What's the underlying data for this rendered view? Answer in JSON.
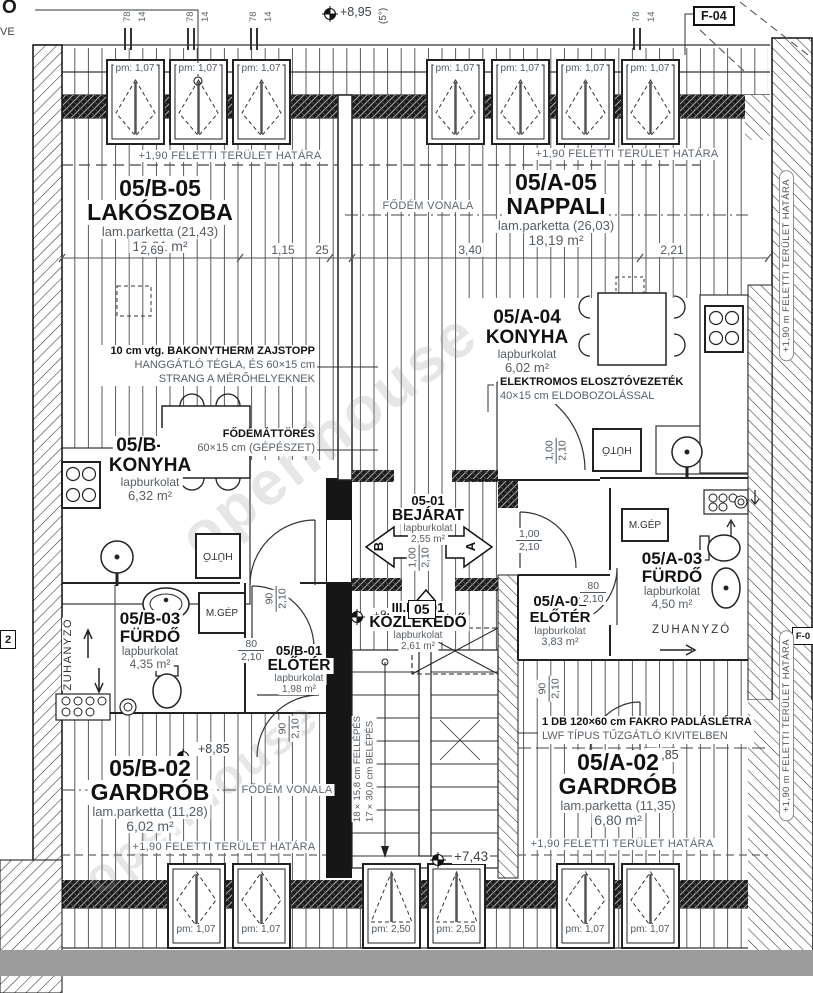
{
  "sheet": {
    "code": "F-04",
    "corner_top": "O",
    "corner_sub": "VE",
    "left_cut": "2",
    "right_cut": "F-0",
    "watermark": "openhouse"
  },
  "notes": {
    "boundary": "+1,90 FELETTI TERÜLET HATÁRA",
    "boundary_side": "+1,90 m FELETTI TERÜLET HATÁRA",
    "fodem": "FŐDÉM VONALA"
  },
  "levels": {
    "roof": "+8,95",
    "roof_angle": "(5°)",
    "entry": "+8,85",
    "gardrob_b": "+8,85",
    "gardrob_a": "+8,85",
    "stair": "+7,43"
  },
  "rooms": [
    {
      "id": "05/B-05",
      "name": "LAKÓSZOBA",
      "finish": "lam.parketta (21,43)",
      "area": "16,01 m²"
    },
    {
      "id": "05/A-05",
      "name": "NAPPALI",
      "finish": "lam.parketta (26,03)",
      "area": "18,19 m²"
    },
    {
      "id": "05/A-04",
      "name": "KONYHA",
      "finish": "lapburkolat",
      "area": "6,02 m²"
    },
    {
      "id": "05/B-04",
      "name": "KONYHA",
      "finish": "lapburkolat",
      "area": "6,32 m²"
    },
    {
      "id": "05-01",
      "name": "BEJÁRAT",
      "finish": "lapburkolat",
      "area": "2,55 m²"
    },
    {
      "id": "05/B-03",
      "name": "FÜRDŐ",
      "finish": "lapburkolat",
      "area": "4,35 m²"
    },
    {
      "id": "05/B-01",
      "name": "ELŐTÉR",
      "finish": "lapburkolat",
      "area": "1,98 m²"
    },
    {
      "id": "III.EM-01",
      "name": "KÖZLEKEDŐ",
      "finish": "lapburkolat",
      "area": "2,61 m²"
    },
    {
      "id": "05/A-01",
      "name": "ELŐTÉR",
      "finish": "lapburkolat",
      "area": "3,83 m²"
    },
    {
      "id": "05/A-03",
      "name": "FÜRDŐ",
      "finish": "lapburkolat",
      "area": "4,50 m²"
    },
    {
      "id": "05/B-02",
      "name": "GARDRÓB",
      "finish": "lam.parketta (11,28)",
      "area": "6,02 m²"
    },
    {
      "id": "05/A-02",
      "name": "GARDRÓB",
      "finish": "lam.parketta (11,35)",
      "area": "6,80 m²"
    }
  ],
  "annotations": {
    "zajstopp": {
      "l1": "10 cm vtg. BAKONYTHERM ZAJSTOPP",
      "l2": "HANGGÁTLÓ TÉGLA, ÉS 60×15 cm",
      "l3": "STRANG A MÉRŐHELYEKNEK"
    },
    "attores": {
      "l1": "FŐDÉMÁTTÖRÉS",
      "l2": "60×15 cm (GÉPÉSZET)"
    },
    "elektromos": {
      "l1": "ELEKTROMOS ELOSZTÓVEZETÉK",
      "l2": "40×15 cm ELDOBOZOLÁSSAL"
    },
    "fakro": {
      "l1": "1 DB 120×60 cm FAKRO PADLÁSLÉTRA",
      "l2": "LWF TÍPUS TŰZGÁTLÓ KIVITELBEN"
    }
  },
  "stair": {
    "note_l1": "18×15,8 cm FELLÉPÉS",
    "note_l2": "17×30,0 cm BELÉPÉS",
    "number": "05",
    "dir_b": "B",
    "dir_a": "A"
  },
  "fixtures": {
    "mgep": "M.GÉP",
    "huto": "HŰTŐ",
    "zuhanyzo": "ZUHANYZÓ"
  },
  "windows": {
    "top": [
      "pm: 1,07",
      "pm: 1,07",
      "pm: 1,07",
      "pm: 1,07",
      "pm: 1,07",
      "pm: 1,07",
      "pm: 1,07"
    ],
    "bottom": [
      "pm: 1,07",
      "pm: 1,07",
      "pm: 2,50",
      "pm: 2,50",
      "pm: 1,07",
      "pm: 1,07"
    ]
  },
  "dims": {
    "horizontal": [
      "2,69",
      "1,15",
      "25",
      "3,40",
      "2,21"
    ],
    "rafter_a": "78",
    "rafter_b": "14",
    "doors": [
      {
        "w": "1,00",
        "h": "2,10"
      },
      {
        "w": "1,00",
        "h": "2,10"
      },
      {
        "w": "90",
        "h": "2,10"
      },
      {
        "w": "80",
        "h": "2,10"
      },
      {
        "w": "80",
        "h": "2,10"
      },
      {
        "w": "90",
        "h": "2,10"
      },
      {
        "w": "90",
        "h": "2,10"
      },
      {
        "w": "1,00",
        "h": "2,10"
      }
    ]
  }
}
